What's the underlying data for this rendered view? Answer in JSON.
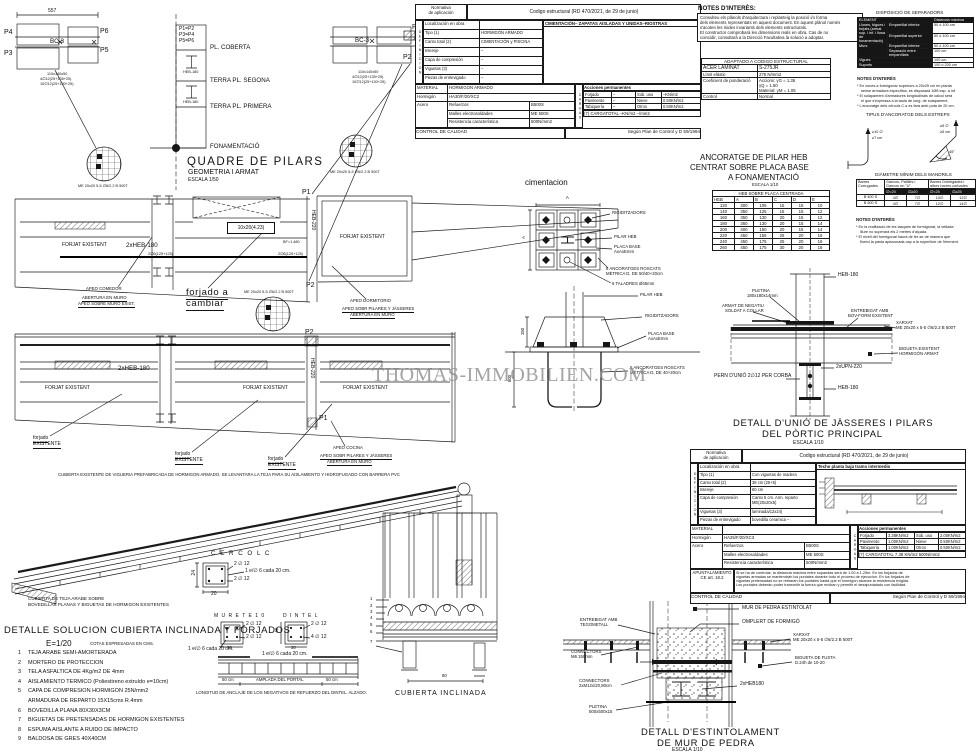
{
  "watermark": "THOMAS-IMMOBILIEN.COM",
  "titles": {
    "quadre": "QUADRE DE PILARS",
    "quadre_sub": "GEOMETRIA I ARMAT",
    "quadre_scale": "ESCALA 1/50",
    "cimentacion": "cimentacion",
    "anc1": "ANCORATGE DE PILAR HEB",
    "anc2": "CENTRAT SOBRE PLACA BASE",
    "anc3": "A FONAMENTACIÓ",
    "anc_scale": "ESCALA 1/10",
    "unio1": "DETALL D'UNIÓ DE JÀSSERES I PILARS",
    "unio2": "DEL PÒRTIC PRINCIPAL",
    "unio_scale": "ESCALA 1/10",
    "est1": "DETALL D'ESTINTOLAMENT",
    "est2": "DE MUR DE PEDRA",
    "est_scale": "ESCALA 1/10",
    "cub_incl": "CUBIERTA INCLINADA",
    "cercol": "C E R C O L   C",
    "murete": "M U R E T E   1 0",
    "dintel": "D I N T E L",
    "tipus": "TIPUS D'ANCORATGE DELS ESTREPS",
    "notes": "NOTES D'INTERÈS:"
  },
  "notes_top": {
    "l1": "Consulteu els plànols d'arquitectura i replanteig la posició i/o forma",
    "l2": "dels elements representats en aquest document. En aquest plànol només",
    "l3": "s'acoten les mides invariants dels elements estructurals.",
    "l4": "El constructor comprobarà les dimensions reals en obra. Cas de no",
    "l5": "coincidir, consultarà a la Direcció Facultativa la solució a adoptar."
  },
  "adaptado": {
    "title": "ADAPTADO A CODIGO ESTRUCTURAL",
    "acer": "ACER LAMINAT",
    "acer_v": "S-275JR",
    "limit": "Límit elàstic",
    "limit_v": "275 N/mm2",
    "coef": "Coeficient de ponderació",
    "coef_v1": "Accions: γG = 1.35",
    "coef_v2": "γQ = 1.50",
    "coef_v3": "Material: γM = 1.05",
    "control": "Control",
    "control_v": "Normal"
  },
  "sep": {
    "title": "DISPOSICIÓ DE SEPARADORS",
    "element": "ELEMENT",
    "dist": "Distància màxima",
    "g1": "Lloses, bigues i forjats (armat sup. i inf. i llosa de fonamentació)",
    "emp_inf": "Emparrillat inferior",
    "emp_sup": "Emparrillat superior",
    "v50": "50 ó 100 cm",
    "murs": "Murs",
    "sep_emp": "Separació entre emparrillats",
    "v100": "100 cm",
    "vigues": "Vigues",
    "suports": "Suports",
    "v200": "100 ó 200 cm",
    "notes_title": "NOTES D'INTERÈS",
    "n1": "* En zones a formigonar superiors a 20x25 cm en planta",
    "n2": "sense armadura específica, es disposarà 1Ø8 esp. a inf.",
    "n3": "* El solapament d'armadures longitudinals de càlcul serà",
    "n4": "el que s'expressa a la taula de long. de solapament.",
    "n5": "* L'ancoratge dels cèrcols C-s es farà amb pota de 20 cm."
  },
  "hooks": {
    "h1": "≥10 ∅",
    "h2": "≥7 cm",
    "h3": "≥5 ∅",
    "h4": "≥5 cm",
    "h5": "45°"
  },
  "mandrils": {
    "title": "DIÀMETRE MÍNIM DELS MANDRILS",
    "c1": "Barres Corrugades",
    "c2": "Ganxos, Patilles i Ganxos en \"U\"",
    "c3": "Barres Doblegades i altres barres corbades",
    "s1": "∅<20",
    "s2": "∅≥20",
    "s3": "∅<25",
    "s4": "∅≥25",
    "rows": [
      [
        "B 400 S",
        "4∅",
        "7∅",
        "10∅",
        "12∅"
      ],
      [
        "B 500 S",
        "4∅",
        "7∅",
        "12∅",
        "14∅"
      ]
    ],
    "notes_title": "NOTES D'INTERÈS",
    "n1": "* En la realització de les tasques de formigonat, la vetlada",
    "n2": "lliure no superarà els 2 metres d'alçada.",
    "n3": "* El nivell del formigonat haurà de fer-se de manera que",
    "n4": "flueixi la pasta apissonada cap a la superfície de l'element."
  },
  "heb": {
    "table_title": "HEB SOBRE PLACA CENTRADA",
    "cols": [
      "HEB",
      "A",
      "B",
      "C",
      "D",
      "E"
    ],
    "rows": [
      [
        "120",
        "300",
        "105",
        "15",
        "15",
        "10"
      ],
      [
        "140",
        "350",
        "125",
        "15",
        "15",
        "12"
      ],
      [
        "160",
        "350",
        "130",
        "20",
        "15",
        "12"
      ],
      [
        "180",
        "350",
        "130",
        "20",
        "15",
        "14"
      ],
      [
        "200",
        "400",
        "150",
        "20",
        "15",
        "14"
      ],
      [
        "220",
        "450",
        "155",
        "25",
        "20",
        "16"
      ],
      [
        "240",
        "450",
        "175",
        "25",
        "20",
        "16"
      ],
      [
        "260",
        "450",
        "175",
        "30",
        "20",
        "18"
      ]
    ]
  },
  "t1": {
    "corner1": "Normativa",
    "corner2": "de aplicación",
    "header": "Codigo estructural (RD 470/2021, de 29 de junio)",
    "def_vert": "DEFINICION",
    "loc_l": "Localización en obra",
    "loc_v": "CIMENTACIÓN– ZAPATAS AISLADAS Y UNIDAS–RIOSTRAS",
    "def_rows": [
      [
        "Tipo (1)",
        "HORMIGÓN ARMADO"
      ],
      [
        "Canto total (2)",
        "CIMENTACIÓN y PISCINA"
      ],
      [
        "Intereje",
        "–"
      ],
      [
        "Capa de compresión",
        "–"
      ],
      [
        "Viguetas (3)",
        "–"
      ],
      [
        "Piezas de entrevigado",
        "–"
      ]
    ],
    "mat": "MATERIAL",
    "mat_v": "HORMIGON ARMADO",
    "horm": "Hormigón",
    "horm_v": "HA30/F/20/XC2",
    "acero": "Acero",
    "ref": "Refuerzos",
    "ref_v": "B500S",
    "malles": "Malles electrosoldades",
    "malles_v": "ME 500S",
    "resist": "Resistencia característica",
    "resist_v": "500N/mm2",
    "cargas_vert": "CARGAS",
    "acc": "Acciones permanentes",
    "cargas_rows": [
      [
        "Forjado",
        "–",
        "Sob. uso",
        "–KN/m2"
      ],
      [
        "Pavimento",
        "–",
        "Nieve",
        "0.50KN/m2"
      ],
      [
        "Tabiquería",
        "–",
        "Otros",
        "0.50KN/m2"
      ]
    ],
    "total": "(7) CARGATOTAL   –KN/m2      –/mm2",
    "control": "CONTROL DE CALIDAD",
    "control_v": "Según Plan de Control y D 59/1994"
  },
  "t2": {
    "corner1": "Normativa",
    "corner2": "de aplicación",
    "header": "Codigo estructural (RD 470/2021, de 29 de junio)",
    "def_vert": "DEFINICION",
    "loc_l": "Localización en obra",
    "loc_v": "Techo planta baja tramo intermedio",
    "def_rows": [
      [
        "Tipo (1)",
        "Con viguetas de madera"
      ],
      [
        "Canto total (2)",
        "38 cm (25+5)"
      ],
      [
        "Intereje",
        "60 cm"
      ],
      [
        "Capa de compresión",
        "Canto 5 cm.  Arm. reparto ME(20x20x5)"
      ],
      [
        "Viguetas (3)",
        "laminada/12x24)"
      ],
      [
        "Piezas de entrevigado",
        "bovedilla ceramica  –"
      ]
    ],
    "mat": "MATERIAL",
    "mat_v": "",
    "horm": "Hormigón",
    "horm_v": "HA25/F/20/XC3",
    "acero": "Acero",
    "ref": "Refuerzos",
    "ref_v": "B500S",
    "malles": "Malles electrosoldades",
    "malles_v": "ME 500S",
    "resist": "Resistencia característica",
    "resist_v": "500N/mm2",
    "cargas_vert": "CARGAS",
    "acc": "Acciones permanentes",
    "cargas_rows": [
      [
        "Forjado",
        "3.38KN/m2",
        "Sob. uso",
        "2.00KN/m2"
      ],
      [
        "Pavimento",
        "1.00KN/m2",
        "Nieve",
        "0.50KN/m2"
      ],
      [
        "Tabiquería",
        "1.00KN/m2",
        "Otros",
        "0.50KN/m2"
      ]
    ],
    "total": "(7) CARGATOTAL  7.38 KN/m2     500N/mm2",
    "apunt1": "APUNTALAMIENTO",
    "apunt2": "CE art. 18.2",
    "ap_n1": "Si se ha de controlar, la distancia máxima entre sopandas será de 1.00 a 1.25m. En los forjados de",
    "ap_n2": "viguetas armadas se mantendrán los puntales durante todo el proceso de ejecución. En los forjados de",
    "ap_n3": "viguetas pretensadas no se retirarán los puntales hasta que el hormigón alcance la resistencia exigida.",
    "ap_n4": "Los puntales deberán poder transmitir la fuerza que reciban y permitir el desapuntalado con facilidad.",
    "control": "CONTROL DE CALIDAD",
    "control_v": "Según Plan de Control y D 59/1994"
  },
  "list": {
    "title": "DETALLE SOLUCION CUBIERTA INCLINADA Y FORJADOS",
    "scale": "E=1/20",
    "cotas": "COTAS EXPRESADAS EN CMS.",
    "items": [
      [
        "1",
        "TEJA ARABE SEMI-AMORTERADA"
      ],
      [
        "2",
        "MORTERO DE PROTECCION"
      ],
      [
        "3",
        "TELA ASFALTICA DE 4Kg/m2 DE 4mm"
      ],
      [
        "4",
        "AISLAMIENTO TERMICO (Poliestireno extruído e=10cm)"
      ],
      [
        "5",
        "CAPA DE COMPRESION HORMIGON 25N/mm2"
      ],
      [
        "",
        "ARMADURA DE REPARTO 15X15cms R.4mm"
      ],
      [
        "6",
        "BOVEDILLA PLANA 80X30X3CM"
      ],
      [
        "7",
        "BIGUETAS DE PRETENSADAS DE HORMIGON EXISTENTES"
      ],
      [
        "8",
        "ESPUMA AISLANTE A RUIDO DE IMPACTO"
      ],
      [
        "9",
        "BALDOSA DE GRES 40X40CM"
      ]
    ]
  },
  "a": {
    "dim557": "557",
    "p1": "P1",
    "p2": "P2",
    "p3": "P3",
    "p4": "P4",
    "p5": "P5",
    "p6": "P6",
    "bc3": "BC-3",
    "note1": "110x140x50",
    "note2": "4∅12(25+135+25)",
    "note3": "10∅12(25+100+25)",
    "p12": "P1=P2",
    "p34": "P3=P4",
    "p56": "P5=P6",
    "coberta": "PL. COBERTA",
    "segona": "TERRA PL. SEGONA",
    "primera": "TERRA PL. PRIMERA",
    "fonament": "FONAMENTACIÓ",
    "heb180": "HEB-180",
    "heb220": "HEB-220",
    "mesh": "ME 20x20 5-5 ∅6/2.2 B 500T",
    "forjat": "FORJAT EXISTENT",
    "heb2": "2xHEB-180",
    "tag": "10x20(4.23)",
    "reinf": "2∅6(125+125)",
    "bf": "BF=1.480",
    "cambiar1": "forjado a",
    "cambiar2": "cambiar",
    "apeo_com": "APEO COMEDOR",
    "ab_muro": "ABERTURA EN MURO",
    "apeo_muro": "APEO SOBRE MURO EXIST.",
    "apeo_dorm": "APEO DORMITORIO",
    "apeo_pil": "APEO SOBR PILARES Y JÀSSERES",
    "apeo_coc": "APEO COCINA",
    "forj_e1": "forjado",
    "forj_e2": "EXISTENTE",
    "roof_note": "CUBIERTA EXISTENTE DE VIGUERIA PREFABRICADA DE HORMIGON ARMADO. SE LEVANTARA LA TEJA PARA SU AISLAMIENTO Y HIDROFUGADO CON BARRERA PVC",
    "teja1": "CUBIERTA DE TEJA ARABE SOBRE",
    "teja2": "BOVEDILLAS PLANAS Y BIGUETAS DE HORMIGON EXISTENTES",
    "rigid": "RIGIDITZADORS",
    "pilar": "PILAR HEB",
    "placa1": "PLACA BASE",
    "placa2": "AxAxEmm",
    "anc1": "6 ANCORATGES ROSCATS",
    "anc2": "MÈTRICA D, DE 50/40+20cm",
    "anc3": "MÈTRICA D, DE 40+20cm",
    "tal": "6 TALADRES Ø45mm",
    "dimA": "A",
    "dim150": "150",
    "dim600": "600",
    "pletina1": "PLETINA",
    "pletina2": "180x180x14mm",
    "armat1": "ARMAT DE NEGATIU",
    "armat2": "SOLDAT A COLLAR",
    "entre1": "ENTREBIGAT AMB",
    "entre2": "BOV-FORM EXISTENT",
    "xarxat1": "XARXAT",
    "xarxat2": "ME 20x20 x 5-5 ∅6/2.2 B 500T",
    "big1": "BIGUETA EXISTENT",
    "big2": "HORMIGÓN ARMAT",
    "upn": "2xUPN-220",
    "pern": "PERN D'UNIÓ 2∅12 PER CORBA",
    "mur": "MUR DE PEDRA ESTINTOLAT",
    "omplert": "OMPLERT DE FORMIGÓ",
    "fusta1": "BIGUETA DE FUSTA",
    "fusta2": "D.24h de 10-20",
    "heb2x": "2xHEB180",
    "tego": "TEGOMETALL",
    "conn": "CONNECTORS",
    "conn_m6": "M6 150mm",
    "conn_m12": "2xM12x/20,80cm",
    "plet500_1": "PLETINA",
    "plet500_2": "500x500x15",
    "o212": "2 ∅ 12",
    "o412": "4 ∅ 12",
    "estribo": "1 e/∅ 6 cada 20 cm.",
    "d24": "24",
    "d20": "20",
    "d30": "30",
    "d40": "40",
    "d80": "80",
    "d50": "50 cm",
    "amplada": "AMPLADA DEL PORTAL",
    "anclaje": "LONGITUD DE ANCLAJE DE LOS NEGATIVOS DE REFUERZO DEL DINTEL.  ALZADO.",
    "k1": "1",
    "k2": "2",
    "k3": "3",
    "k4": "4",
    "k5": "5",
    "k6": "6",
    "k7": "7"
  }
}
